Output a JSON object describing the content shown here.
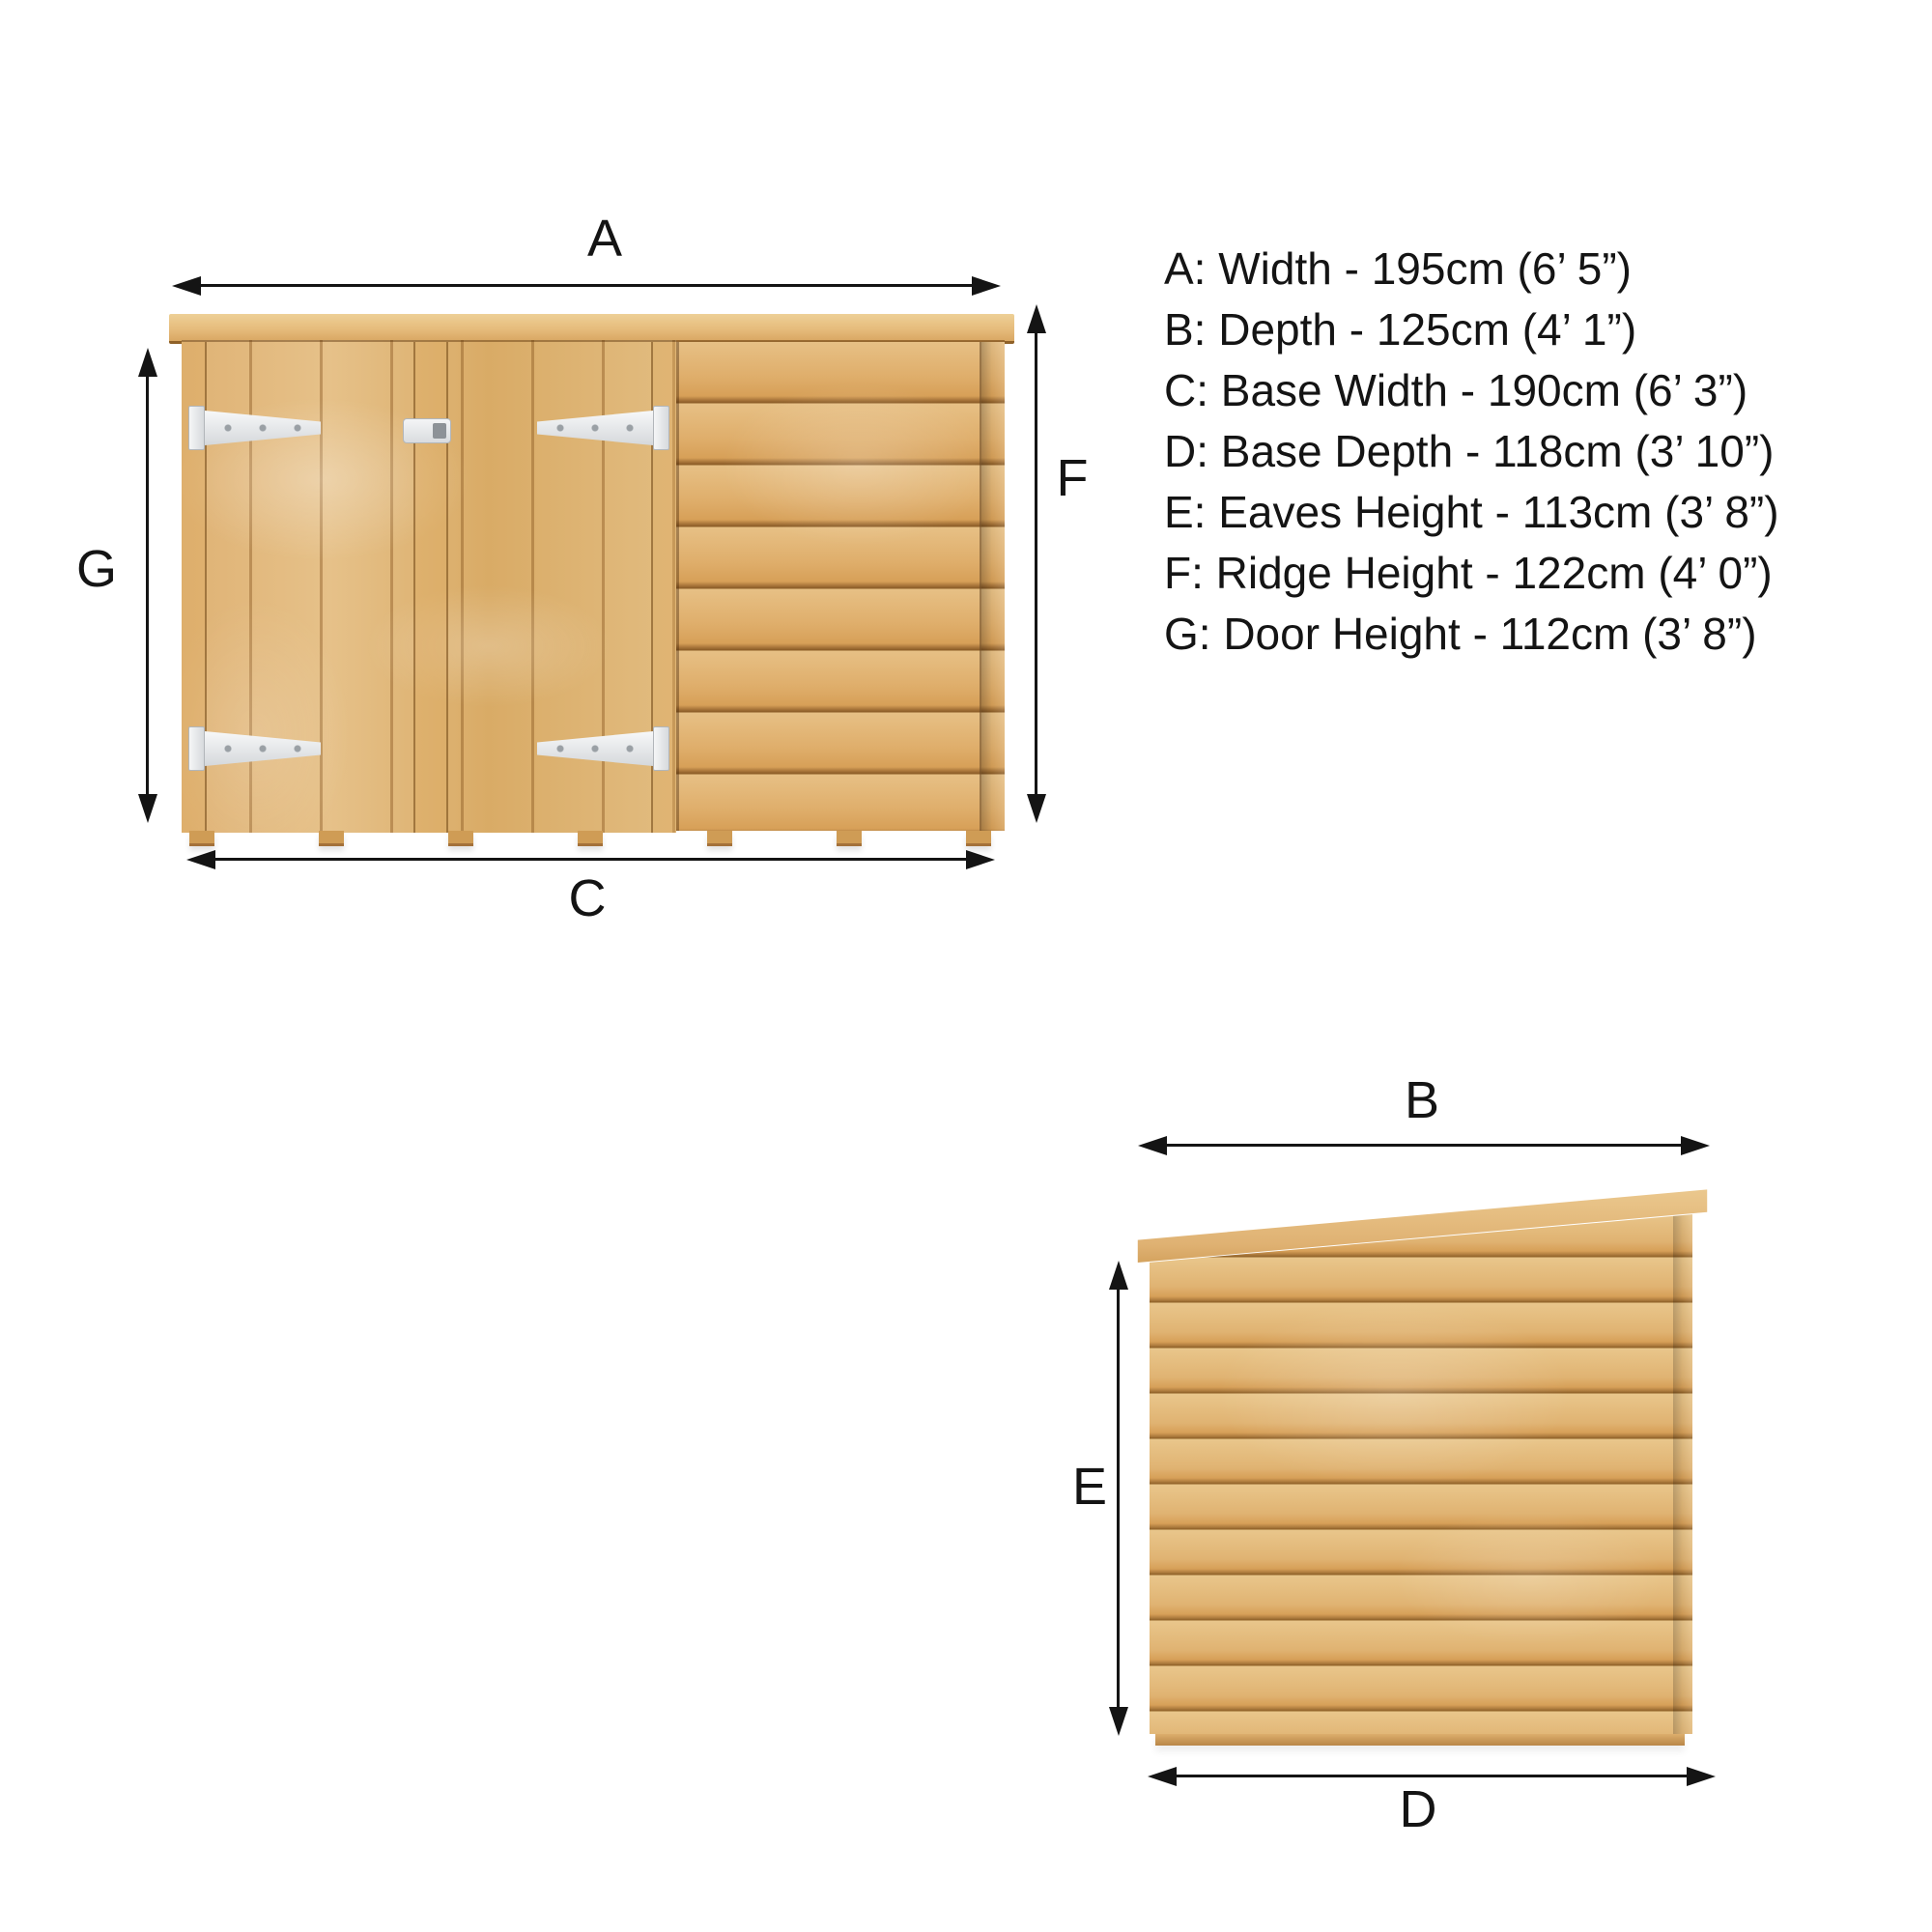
{
  "diagram_title": "Shed dimension diagram",
  "labels": {
    "a": "A",
    "b": "B",
    "c": "C",
    "d": "D",
    "e": "E",
    "f": "F",
    "g": "G"
  },
  "dims": [
    {
      "text": "A: Width - 195cm (6’ 5”)"
    },
    {
      "text": "B: Depth - 125cm (4’ 1”)"
    },
    {
      "text": "C: Base Width - 190cm (6’ 3”)"
    },
    {
      "text": "D: Base Depth - 118cm (3’ 10”)"
    },
    {
      "text": "E: Eaves Height - 113cm (3’ 8”)"
    },
    {
      "text": "F: Ridge Height - 122cm (4’ 0”)"
    },
    {
      "text": "G: Door Height - 112cm (3’ 8”)"
    }
  ],
  "colors": {
    "background": "#ffffff",
    "text": "#141414",
    "arrow": "#141414",
    "wood_base": "#e0b273",
    "wood_groove": "#a9763a",
    "wood_highlight": "#eed3a0",
    "roof": "#e6bc7c",
    "hinge": "#eef0f2"
  }
}
